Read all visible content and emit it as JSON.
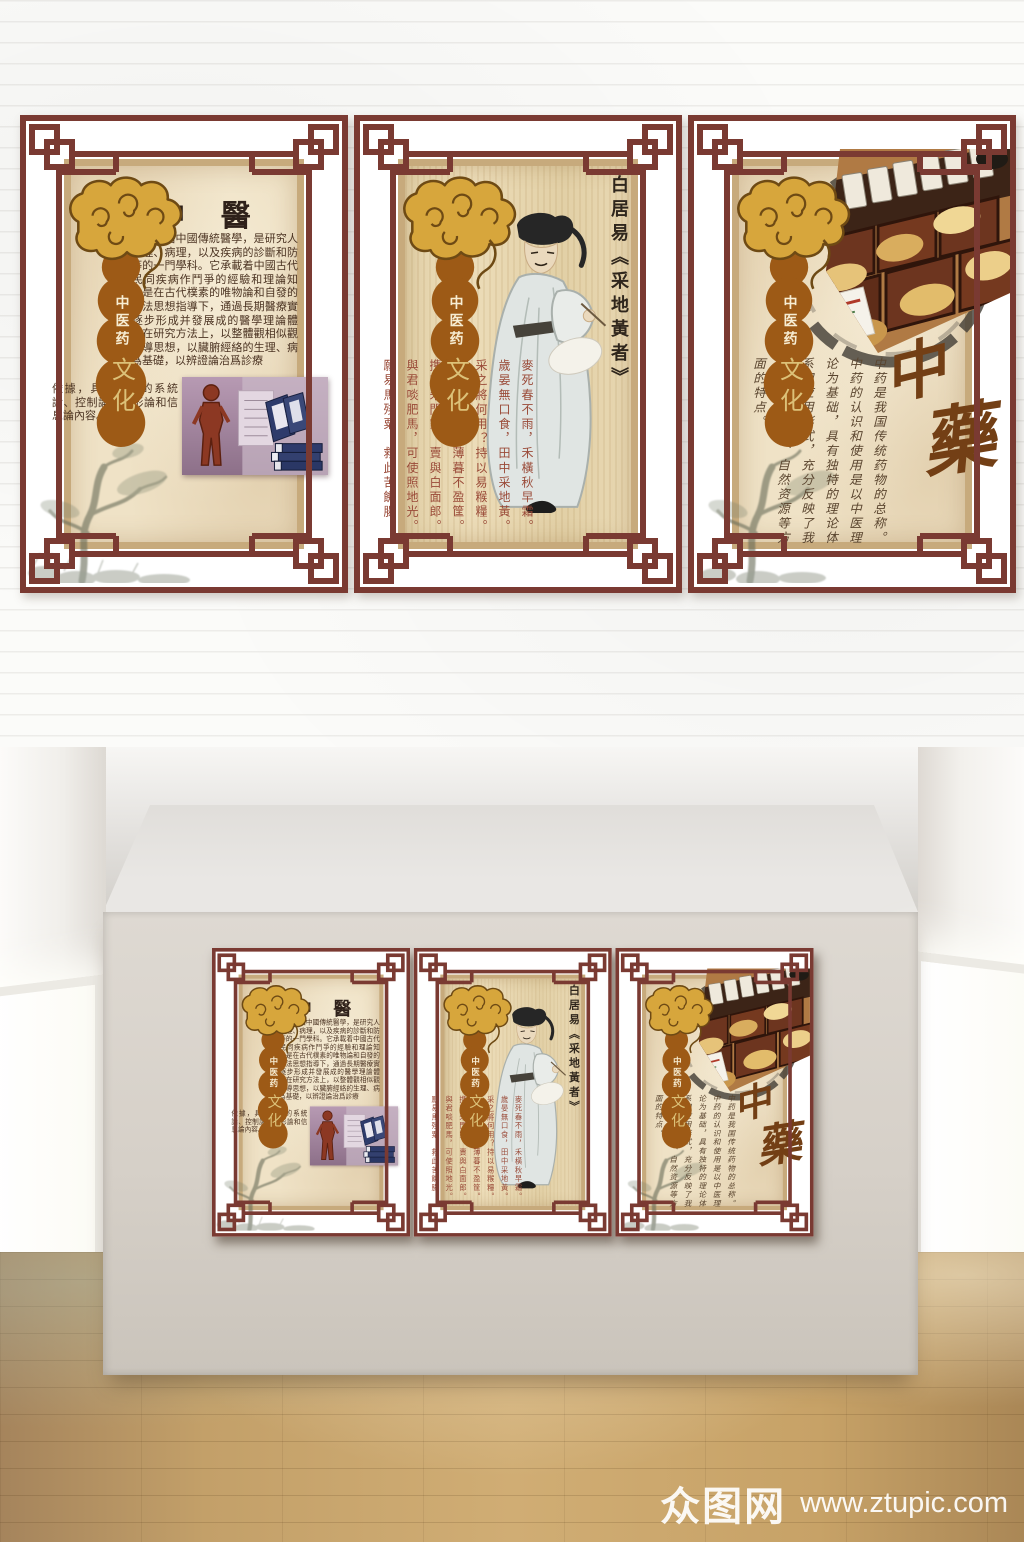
{
  "badge": {
    "line1": "中医药",
    "line2": "文化"
  },
  "panel_zhongyi": {
    "title": "中 醫",
    "body_part1": "中醫指中國傳統醫學，是研究人體生理、病理，以及疾病的診斷和防治等的一門學科。它承載着中國古代人民同疾病作鬥爭的經驗和理論知識，是在古代樸素的唯物論和自發的辨證法思想指導下，通過長期醫療實踐逐步形成并發展成的醫學理論體系。在研究方法上，以整體觀相似觀爲主導思想，以臟腑經絡的生理、病理爲基礎，以辨證論治爲診療",
    "body_part2": "依據，具有樸素的系統論、控制論，分形論和信息論內容。"
  },
  "panel_poem": {
    "title": "白居易《采地黃者》",
    "lines": [
      "麥死春不雨，禾橫秋早霜。",
      "歲晏無口食，田中采地黃。",
      "采之將何用？持以易糇糧。",
      "凌晨荷鋤去，薄暮不盈筐。",
      "携來朱門家，賣與白面郎。",
      "與君啖肥馬，可使照地光。",
      "願易馬殘粟，救此苦饑腸。"
    ]
  },
  "panel_zhongyao": {
    "char1": "中",
    "char2": "藥",
    "body": "中药是我国传统药物的总称。中药的认识和使用是以中医理论为基础，具有独特的理论体系和应用形式，充分反映了我国历史、文化、自然资源等方面的特点。"
  },
  "watermark": {
    "logo": "众图网",
    "url": "www.ztupic.com"
  },
  "colors": {
    "frame_maroon": "#7a3a32",
    "parchment": "#efe2c6",
    "gourd_brown": "#9d5a16",
    "cloud_gold": "#d7a63c",
    "poem_red": "#9a4a38",
    "ink_brown": "#5a452f",
    "wood_floor": "#c3a069"
  }
}
